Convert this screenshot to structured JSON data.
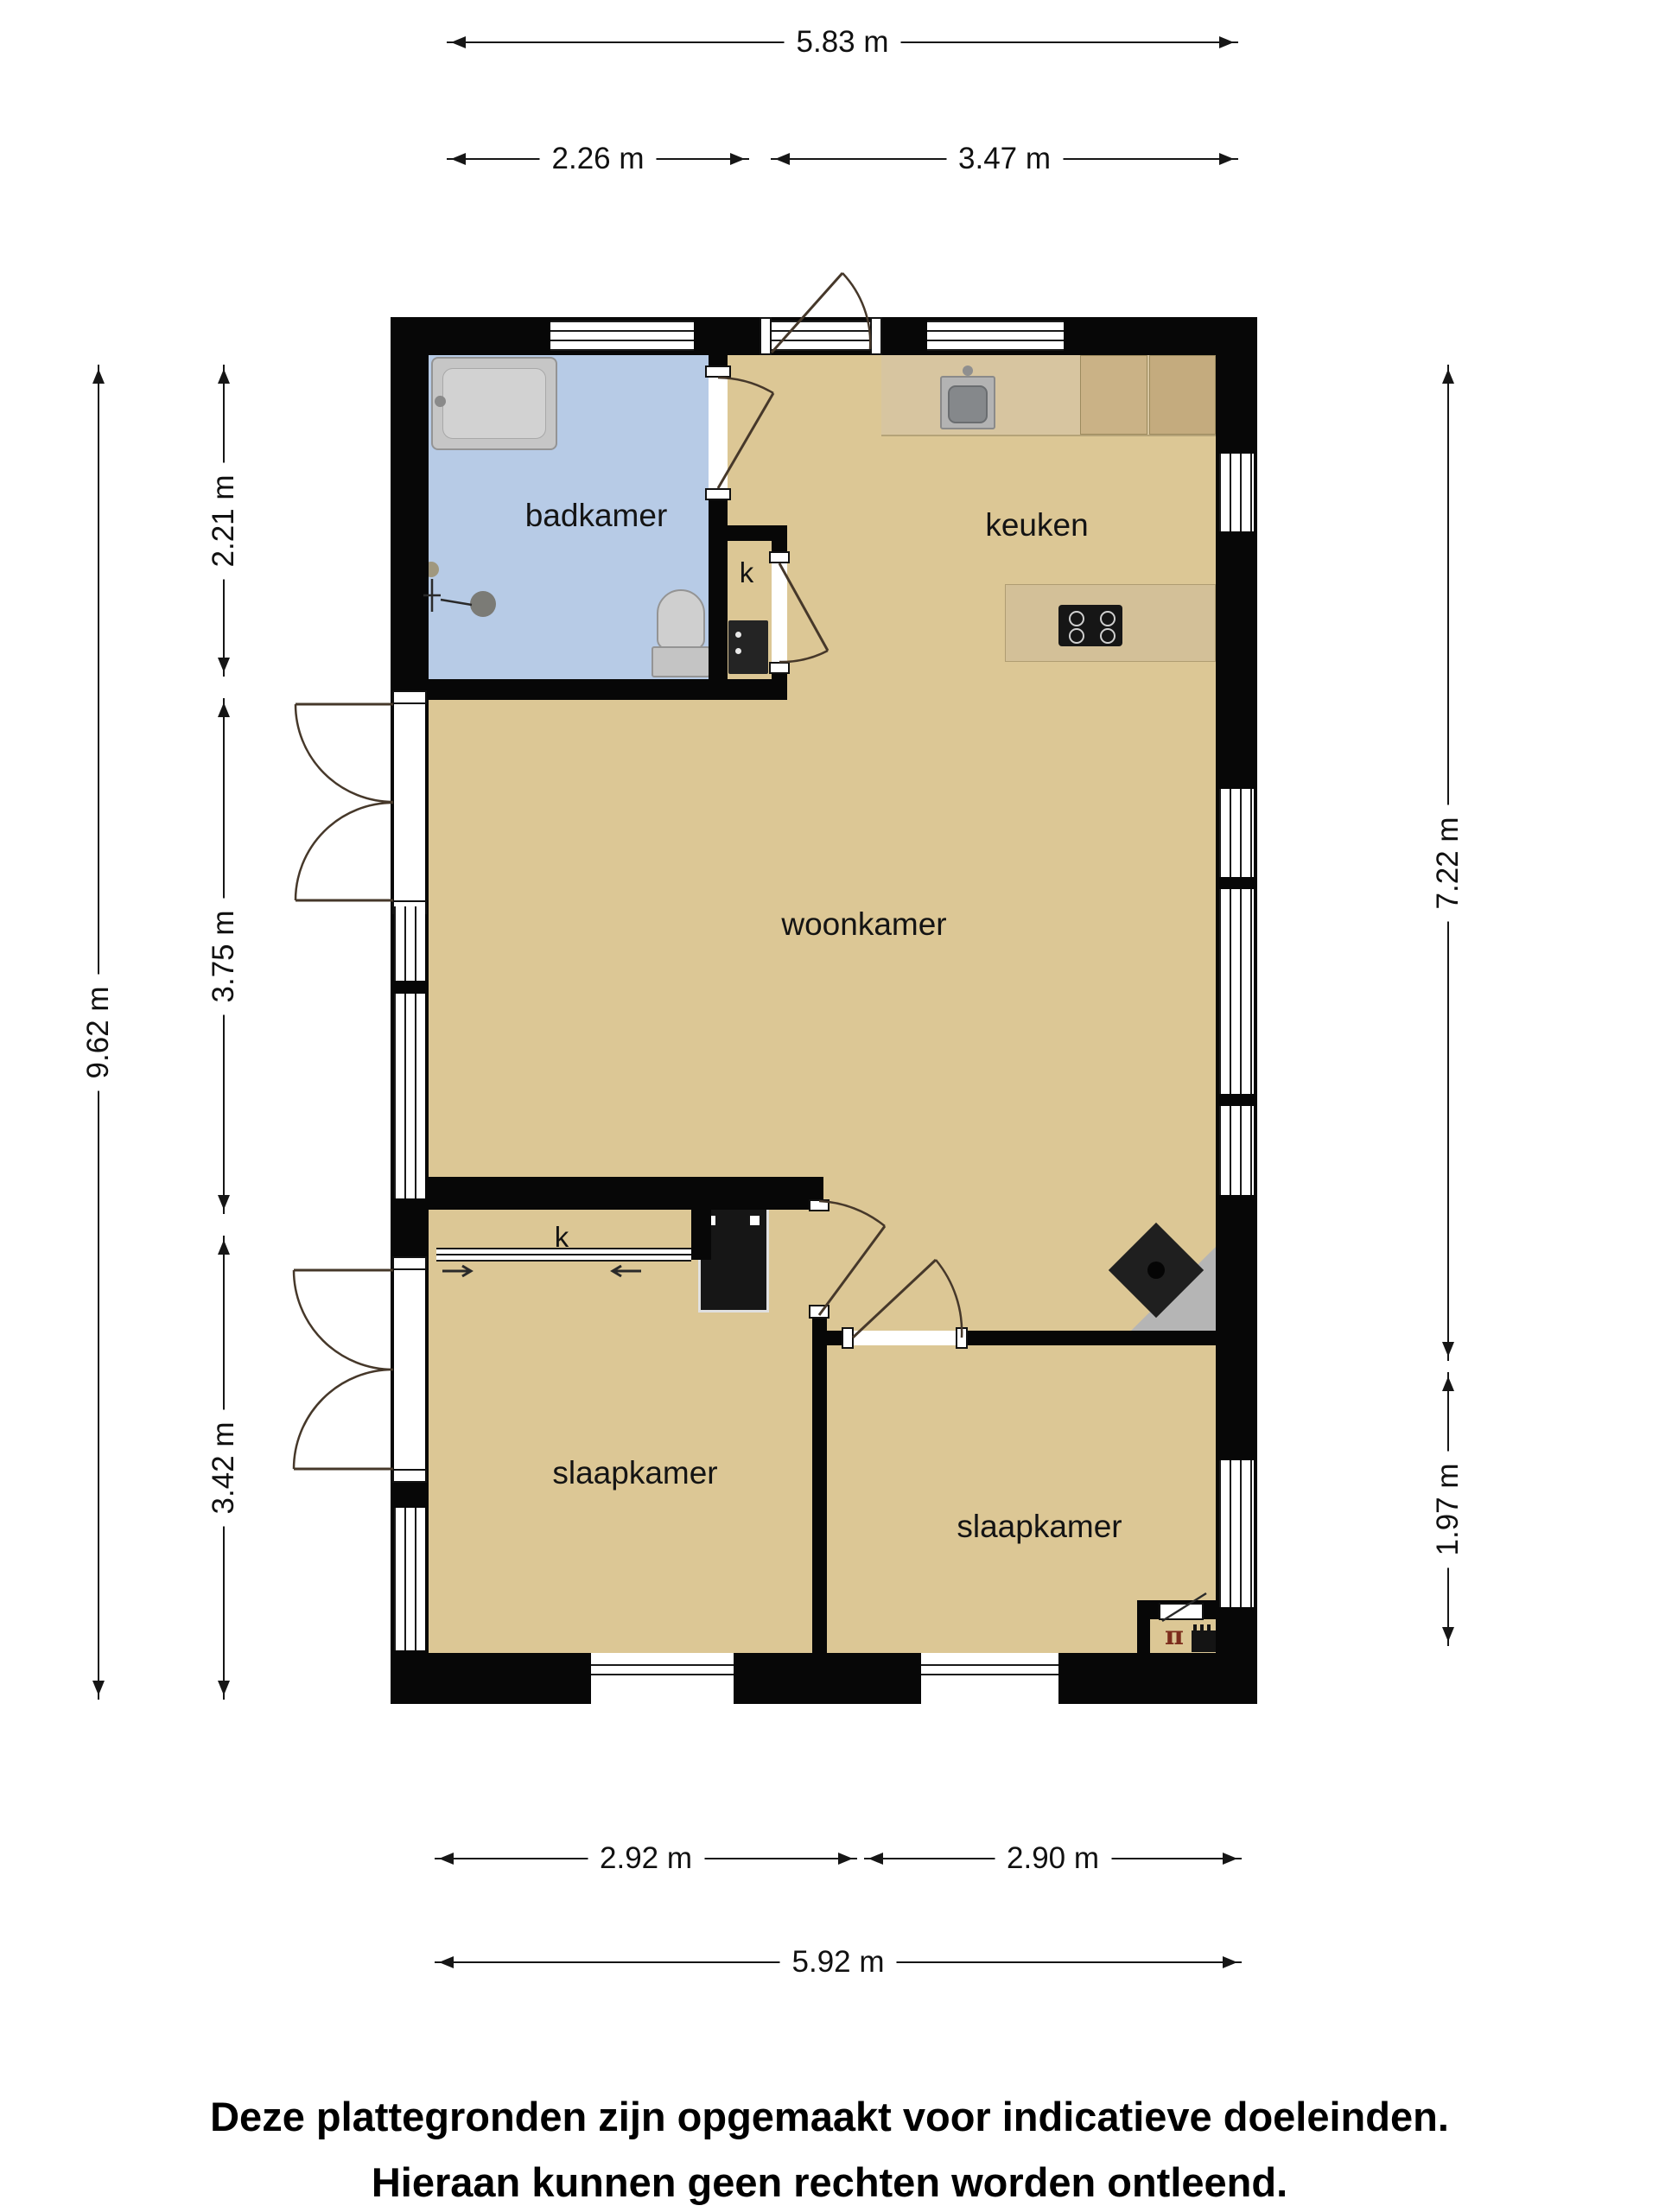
{
  "floorplan": {
    "rooms": {
      "bathroom": "badkamer",
      "kitchen": "keuken",
      "living_room": "woonkamer",
      "bedroom_1": "slaapkamer",
      "bedroom_2": "slaapkamer",
      "closet_1": "k",
      "closet_2": "k"
    },
    "dimensions": {
      "width_total_top": "5.83 m",
      "width_bathroom": "2.26 m",
      "width_kitchen": "3.47 m",
      "height_total_left": "9.62 m",
      "height_bathroom": "2.21 m",
      "height_living_mid": "3.75 m",
      "height_bedrooms": "3.42 m",
      "height_right_upper": "7.22 m",
      "height_right_lower": "1.97 m",
      "width_bedroom_1": "2.92 m",
      "width_bedroom_2": "2.90 m",
      "width_total_bottom": "5.92 m"
    },
    "disclaimer": {
      "line1": "Deze plattegronden zijn opgemaakt voor indicatieve doeleinden.",
      "line2": "Hieraan kunnen geen rechten worden ontleend."
    },
    "symbols": {
      "crawl_space_tap": "π"
    },
    "colors": {
      "wall": "#070707",
      "floor": "#dcc795",
      "bathroom_floor": "#b7cbe6",
      "counter_wood": "#d7c5a0",
      "cabinet_wood": "#c9b287",
      "fixture_gray": "#c9c9c9",
      "hearth_gray": "#b5b5b5",
      "appliance_black": "#161616",
      "dimension_ink": "#161616"
    }
  }
}
